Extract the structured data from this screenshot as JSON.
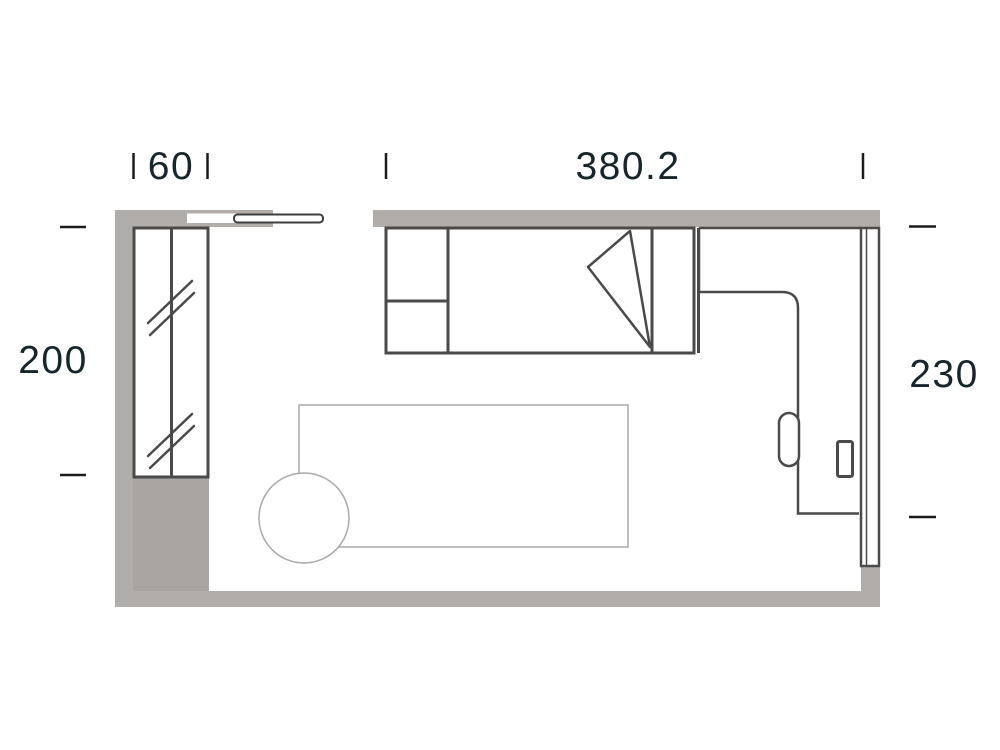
{
  "plan": {
    "title": "room-floor-plan",
    "dimensions": {
      "wardrobe_width": {
        "value": "60",
        "side": "top-left"
      },
      "top_width": {
        "value": "380.2",
        "side": "top"
      },
      "left_height": {
        "value": "200",
        "side": "left"
      },
      "right_height": {
        "value": "230",
        "side": "right"
      }
    },
    "furniture_items": [
      {
        "name": "wardrobe-two-door"
      },
      {
        "name": "sliding-door-panel"
      },
      {
        "name": "single-bed-with-folded-blanket"
      },
      {
        "name": "l-shaped-corner-desk"
      },
      {
        "name": "desk-chair-handle"
      },
      {
        "name": "desk-accessory"
      },
      {
        "name": "right-wall-panel"
      },
      {
        "name": "rug"
      },
      {
        "name": "round-stool"
      }
    ]
  },
  "colors": {
    "bg": "#ffffff",
    "wall": "#b1adaa",
    "wall-dark": "#a9a5a2",
    "stroke": "#4a4a4a",
    "stroke-light": "#a9a9a9",
    "ink": "#16262b",
    "tick": "#1b1b1b"
  }
}
